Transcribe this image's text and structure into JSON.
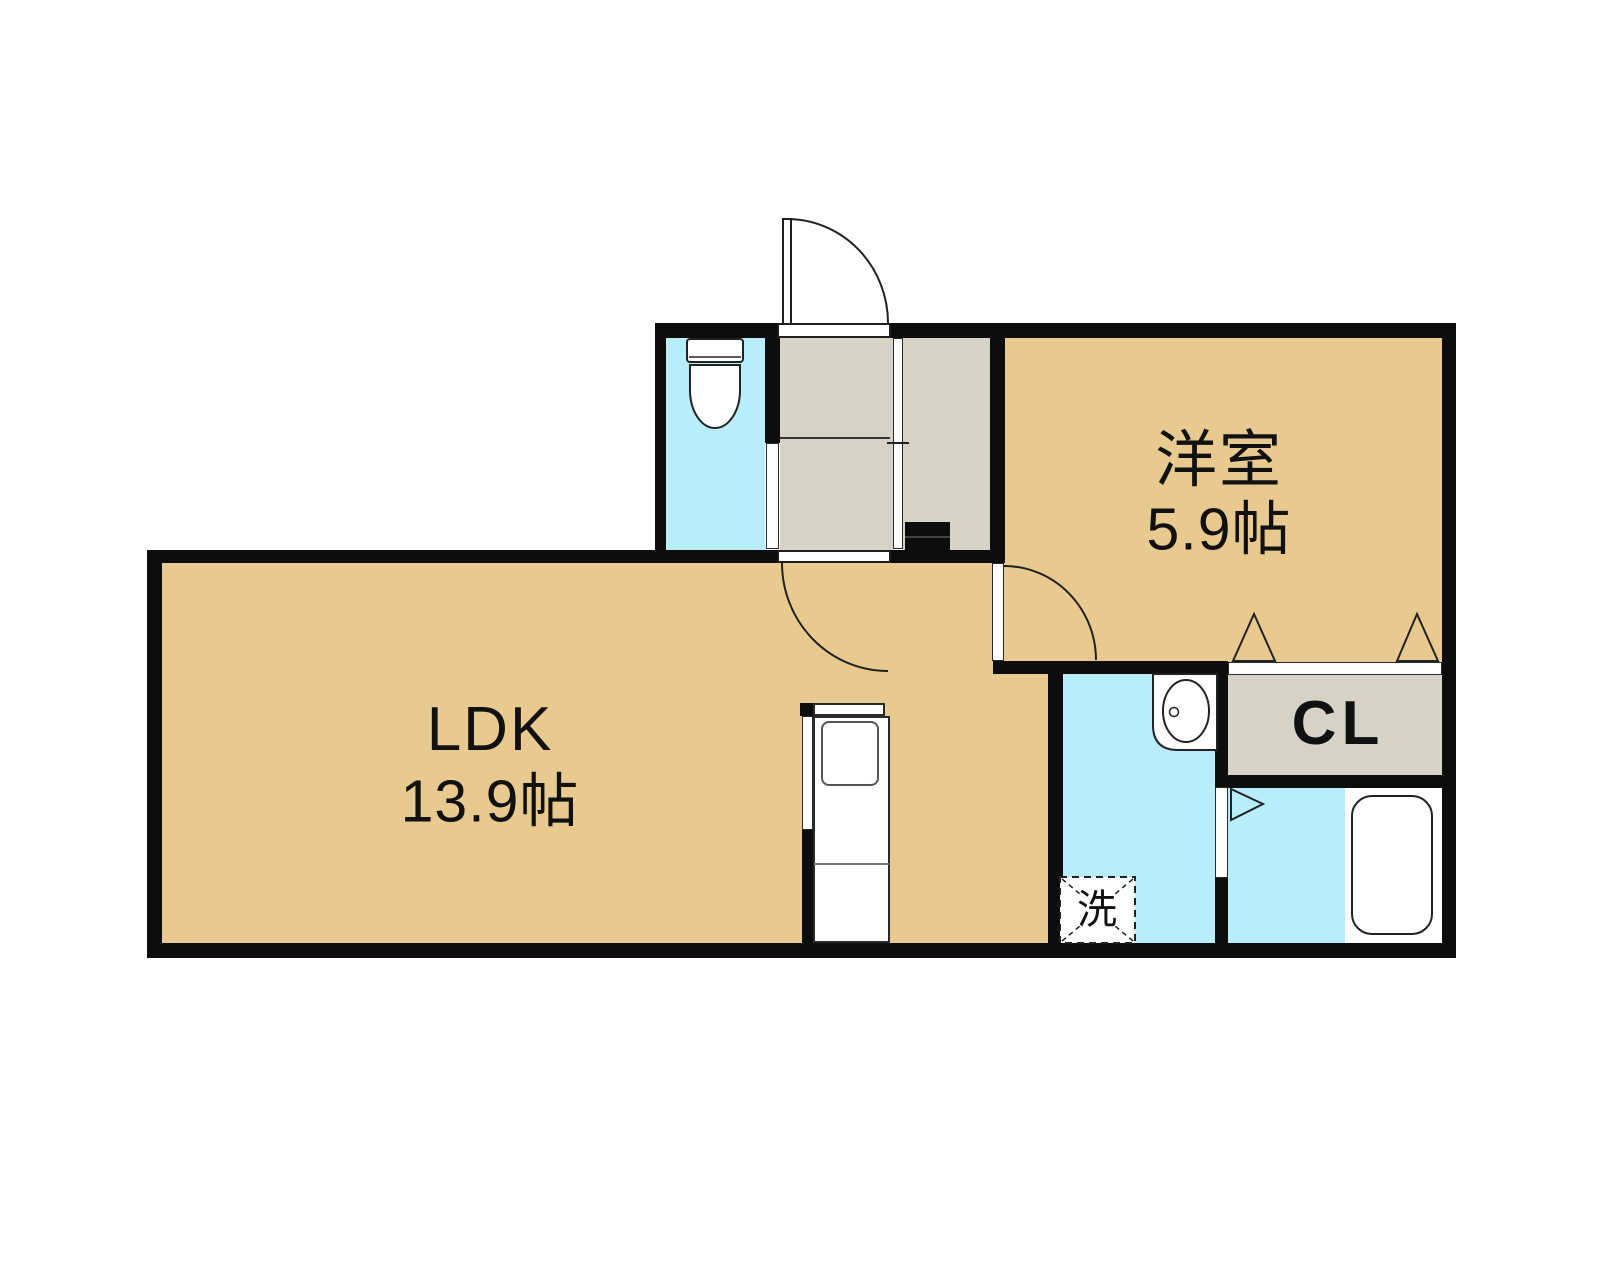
{
  "plan": {
    "type": "apartment-floor-plan",
    "rooms": {
      "ldk": {
        "name": "LDK",
        "size": "13.9帖"
      },
      "bedroom": {
        "name": "洋室",
        "size": "5.9帖"
      },
      "closet": {
        "label": "CL"
      },
      "laundry": {
        "label": "洗"
      }
    },
    "colors": {
      "flooring": "#e8ca90",
      "wet_area": "#b8edfb",
      "entrance_gray": "#d6d3c6",
      "wall": "#0d0d0d",
      "background": "#ffffff"
    }
  }
}
